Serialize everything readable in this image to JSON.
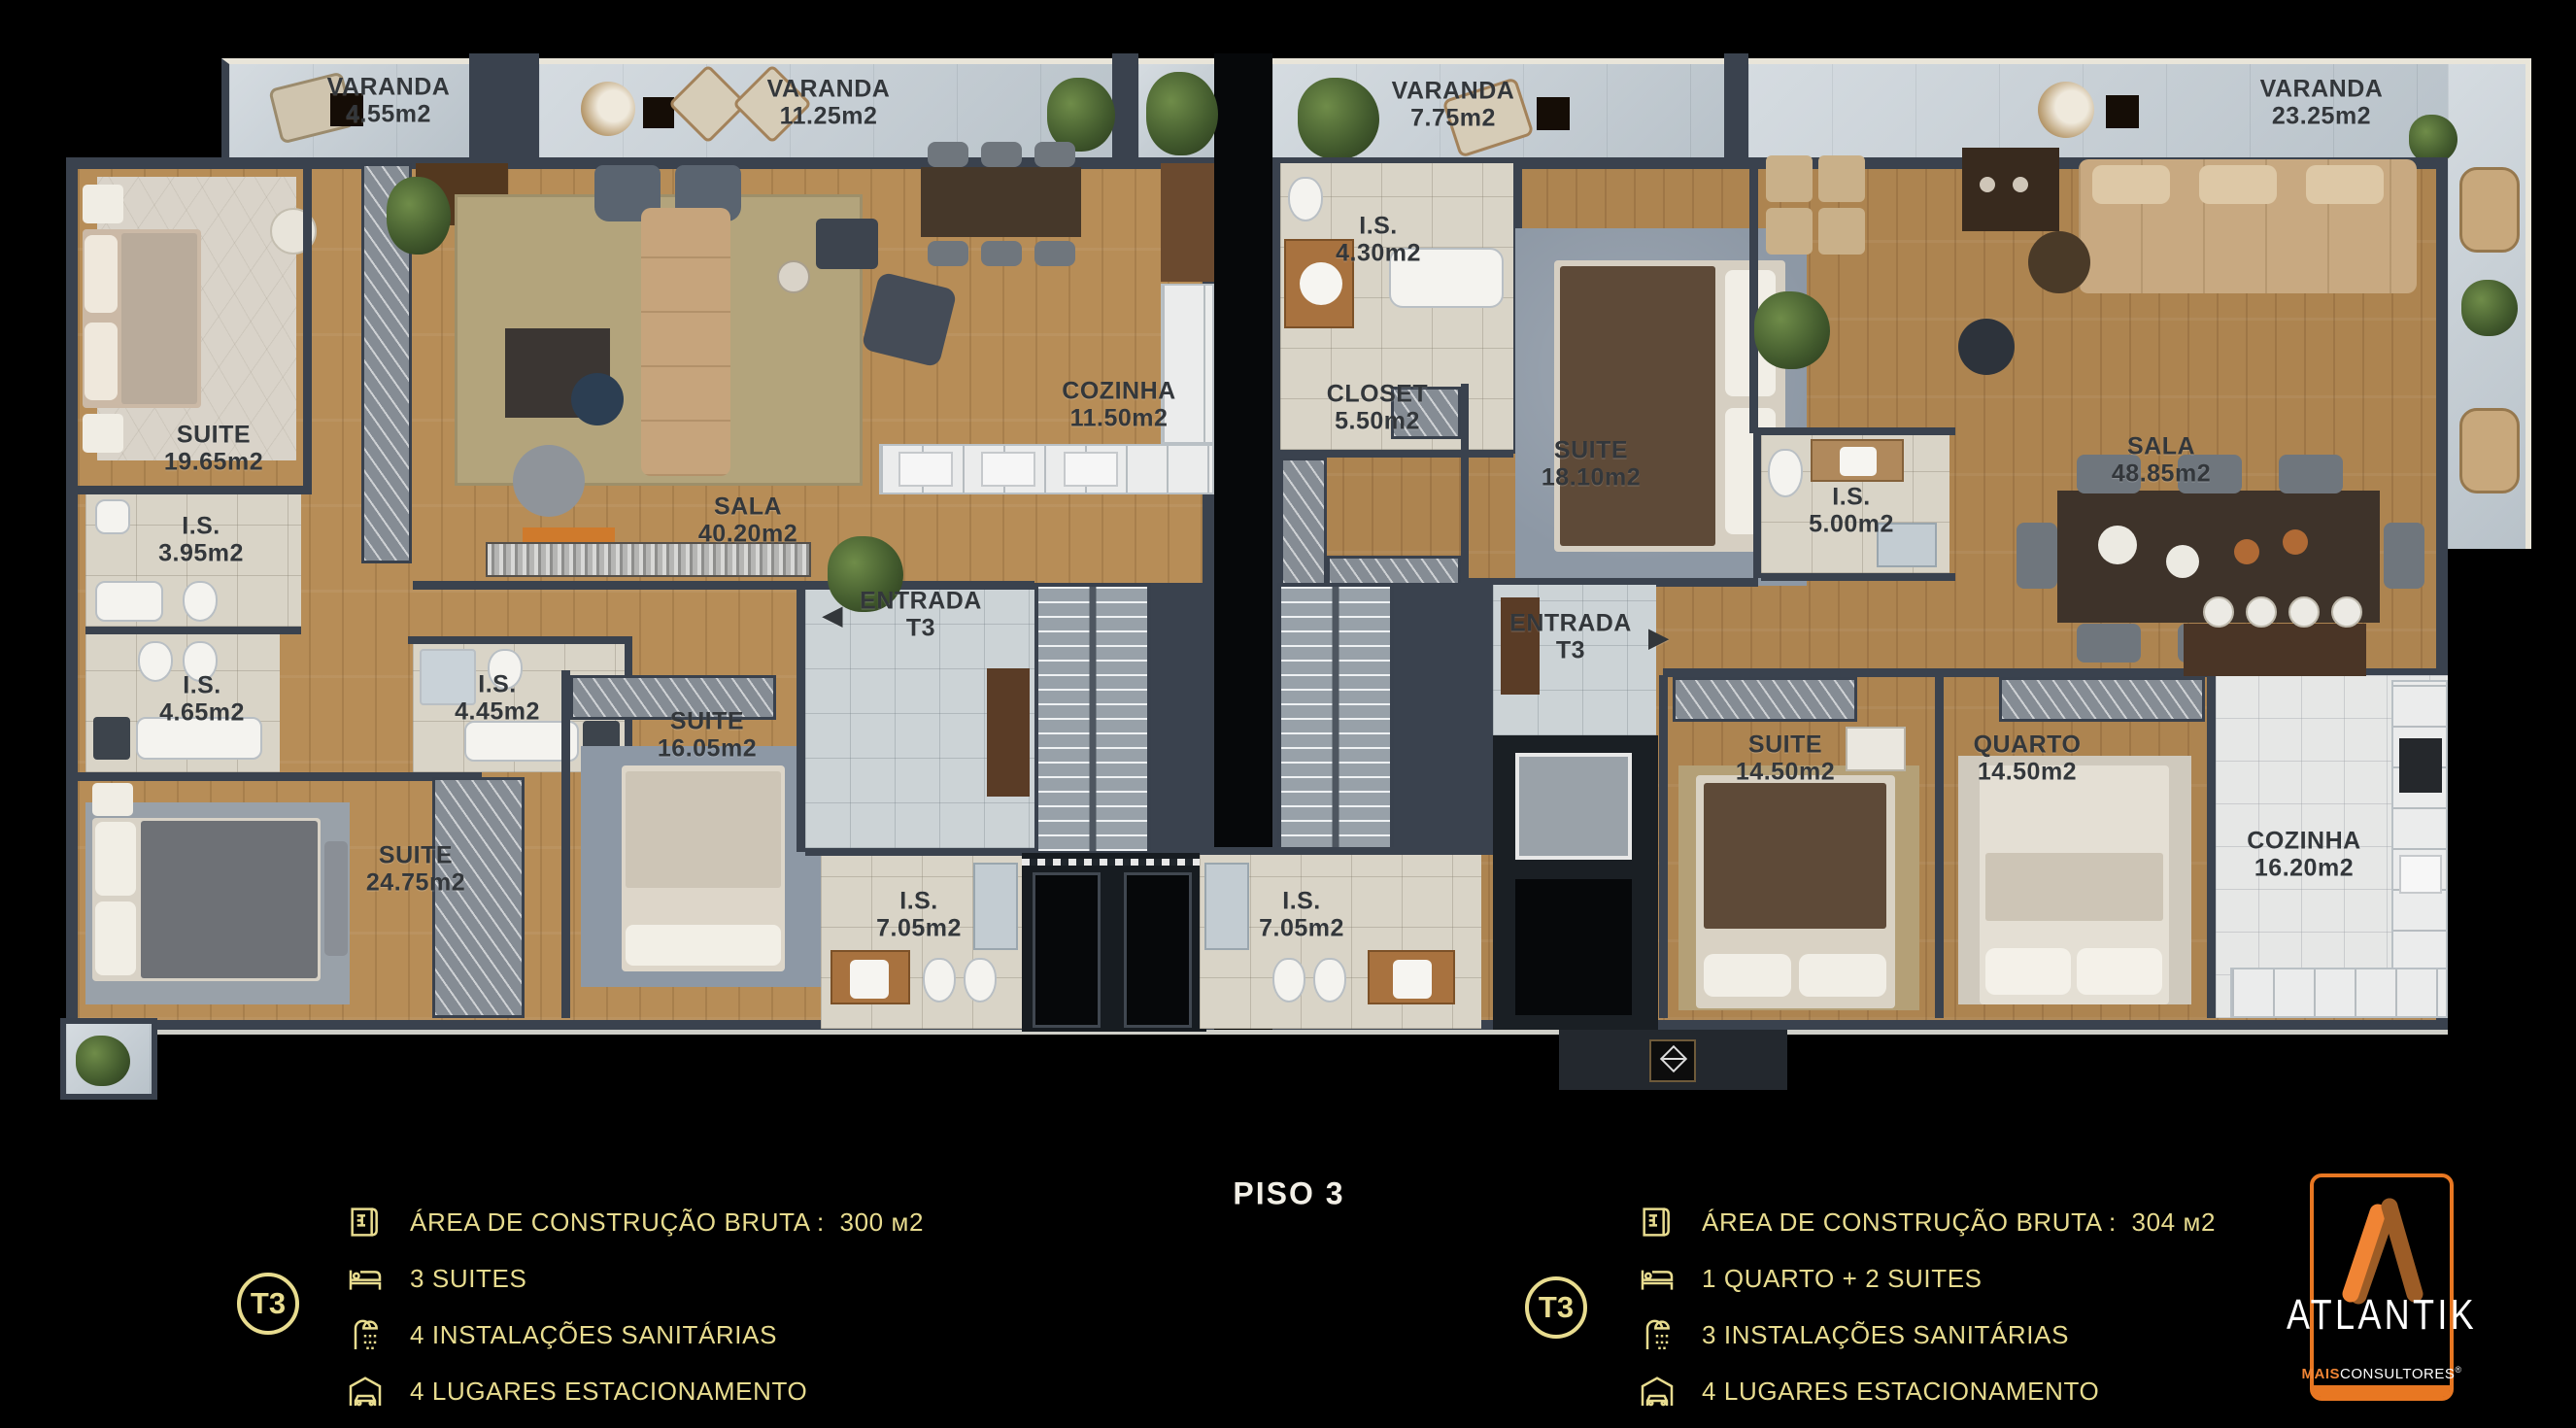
{
  "rooms": {
    "varanda_1": {
      "name": "VARANDA",
      "area": "4.55m2"
    },
    "varanda_2": {
      "name": "VARANDA",
      "area": "11.25m2"
    },
    "varanda_3": {
      "name": "VARANDA",
      "area": "7.75m2"
    },
    "varanda_4": {
      "name": "VARANDA",
      "area": "23.25m2"
    },
    "suite_19": {
      "name": "SUITE",
      "area": "19.65m2"
    },
    "is_395": {
      "name": "I.S.",
      "area": "3.95m2"
    },
    "is_465": {
      "name": "I.S.",
      "area": "4.65m2"
    },
    "suite_24": {
      "name": "SUITE",
      "area": "24.75m2"
    },
    "is_445": {
      "name": "I.S.",
      "area": "4.45m2"
    },
    "suite_16": {
      "name": "SUITE",
      "area": "16.05m2"
    },
    "sala_1": {
      "name": "SALA",
      "area": "40.20m2"
    },
    "cozinha_1": {
      "name": "COZINHA",
      "area": "11.50m2"
    },
    "entrada_1": {
      "name": "ENTRADA",
      "area": "T3",
      "arrow": "◀"
    },
    "is_705_left": {
      "name": "I.S.",
      "area": "7.05m2"
    },
    "is_430": {
      "name": "I.S.",
      "area": "4.30m2"
    },
    "closet": {
      "name": "CLOSET",
      "area": "5.50m2"
    },
    "suite_18": {
      "name": "SUITE",
      "area": "18.10m2"
    },
    "is_500": {
      "name": "I.S.",
      "area": "5.00m2"
    },
    "sala_2": {
      "name": "SALA",
      "area": "48.85m2"
    },
    "entrada_2": {
      "name": "ENTRADA",
      "area": "T3",
      "arrow": "▶"
    },
    "is_705_right": {
      "name": "I.S.",
      "area": "7.05m2"
    },
    "suite_14": {
      "name": "SUITE",
      "area": "14.50m2"
    },
    "quarto": {
      "name": "QUARTO",
      "area": "14.50m2"
    },
    "cozinha_2": {
      "name": "COZINHA",
      "area": "16.20m2"
    }
  },
  "floor_title": "PISO 3",
  "legend_left": {
    "badge": "T3",
    "area_label": "ÁREA DE CONSTRUÇÃO BRUTA :",
    "area_value": "300 м2",
    "rooms_line": "3 SUITES",
    "sanitary_line": "4 INSTALAÇÕES SANITÁRIAS",
    "parking_line": "4 LUGARES ESTACIONAMENTO"
  },
  "legend_right": {
    "badge": "T3",
    "area_label": "ÁREA DE CONSTRUÇÃO BRUTA :",
    "area_value": "304 м2",
    "rooms_line": "1 QUARTO + 2 SUITES",
    "sanitary_line": "3 INSTALAÇÕES SANITÁRIAS",
    "parking_line": "4 LUGARES ESTACIONAMENTO"
  },
  "logo": {
    "brand": "ATLANTIK",
    "sub_bold": "MAIS",
    "sub_regular": "CONSULTORES",
    "registered": "®"
  },
  "colors": {
    "accent_orange": "#e87722",
    "legend_gold": "#e8dc8f",
    "wall": "#3a424e"
  }
}
